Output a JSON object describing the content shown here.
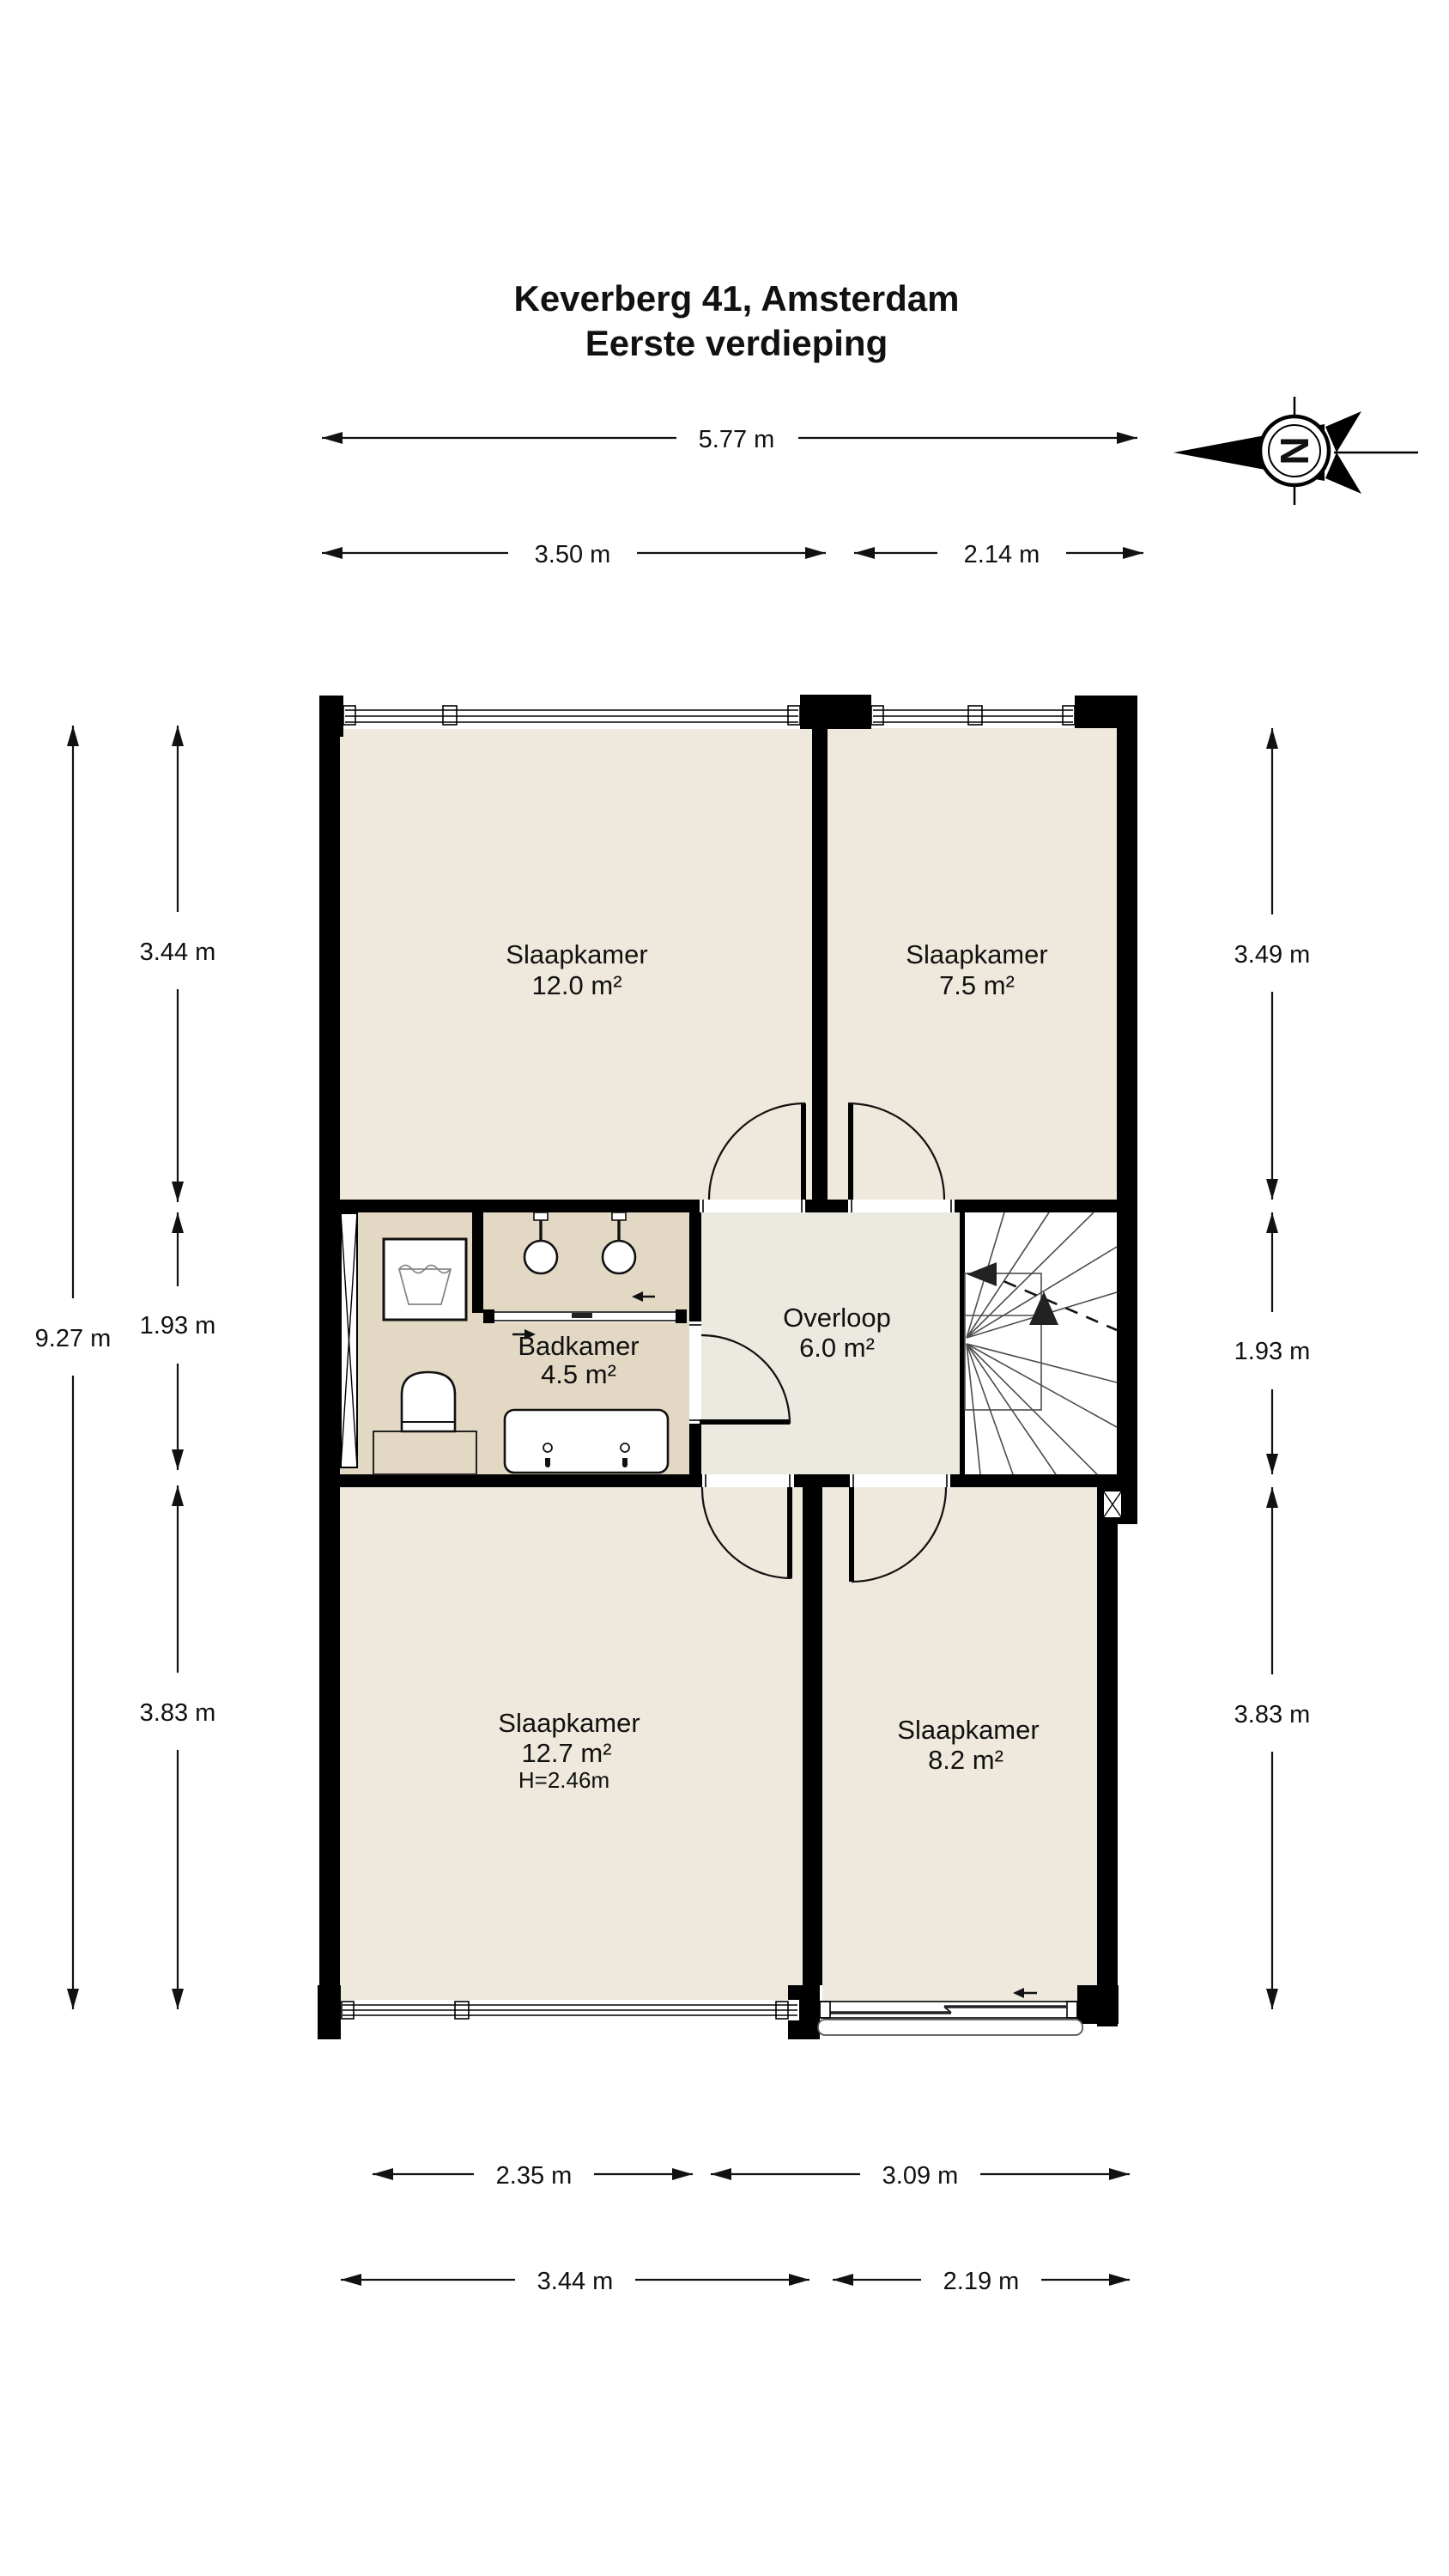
{
  "title": {
    "line1": "Keverberg 41, Amsterdam",
    "line2": "Eerste verdieping"
  },
  "compass": {
    "letter": "N"
  },
  "rooms": [
    {
      "id": "slaapkamer-12-0",
      "name": "Slaapkamer",
      "area": "12.0 m²"
    },
    {
      "id": "slaapkamer-7-5",
      "name": "Slaapkamer",
      "area": "7.5 m²"
    },
    {
      "id": "badkamer",
      "name": "Badkamer",
      "area": "4.5 m²"
    },
    {
      "id": "overloop",
      "name": "Overloop",
      "area": "6.0 m²"
    },
    {
      "id": "slaapkamer-12-7",
      "name": "Slaapkamer",
      "area": "12.7 m²",
      "height": "H=2.46m"
    },
    {
      "id": "slaapkamer-8-2",
      "name": "Slaapkamer",
      "area": "8.2 m²"
    }
  ],
  "dimensions": {
    "top_total": "5.77 m",
    "top_left": "3.50 m",
    "top_right": "2.14 m",
    "left_total": "9.27 m",
    "left_upper": "3.44 m",
    "left_middle": "1.93 m",
    "left_lower": "3.83 m",
    "right_upper": "3.49 m",
    "right_middle": "1.93 m",
    "right_lower": "3.83 m",
    "bottom_inner_left": "2.35 m",
    "bottom_inner_right": "3.09 m",
    "bottom_outer_left": "3.44 m",
    "bottom_outer_right": "2.19 m"
  },
  "colors": {
    "wall": "#000000",
    "bedroom_floor": "#EEE9DC",
    "hall_floor": "#ECE9E0",
    "bathroom_floor": "#E3D8C4",
    "stairs": "#FFFFFF"
  }
}
